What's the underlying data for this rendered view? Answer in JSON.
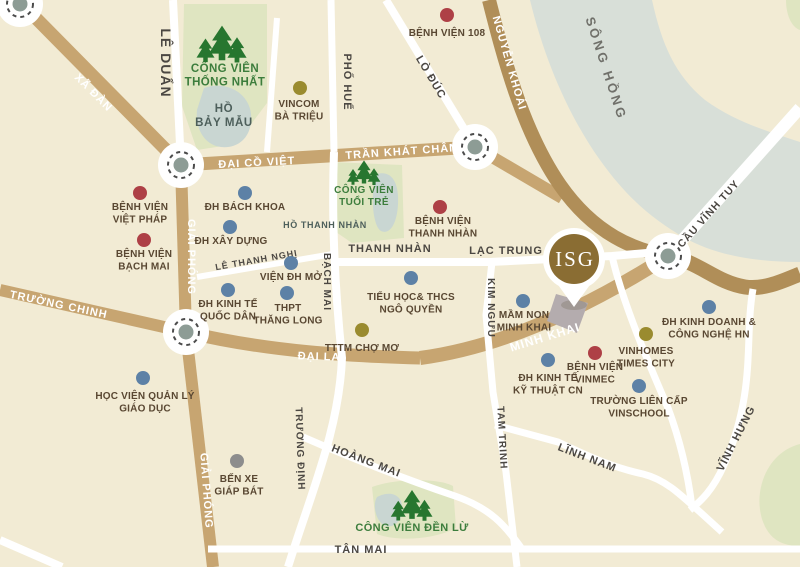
{
  "map": {
    "colors": {
      "background": "#f2ebd4",
      "road_main": "#c7a571",
      "road_dark": "#b08e58",
      "road_white": "#ffffff",
      "river": "#d8dfd8",
      "lake": "#c9d6d2",
      "park": "#dfe5c1",
      "tree_green": "#27762f",
      "park_text": "#3c7d3c",
      "lake_text": "#4d5f5b",
      "river_text": "#70706a",
      "poi_text": "#594732",
      "hospital": "#ae4046",
      "university": "#5d81a6",
      "commercial": "#9a8b2f",
      "bus": "#8d8d8d",
      "plot": "#b4acae",
      "marker_gold": "#8a6d33",
      "roundabout_dash": "#4c4c4c",
      "roundabout_center": "#8d9c95"
    },
    "river": {
      "name": "Sông Hồng",
      "path": "M530,0 L652,0 C662,45 675,75 705,100 C735,122 770,132 800,142 L800,262 C755,262 715,255 685,238 C650,218 625,195 600,160 C570,118 545,62 530,0 Z"
    },
    "parks": [
      {
        "id": "cong-vien-thong-nhat",
        "path": "M184,4 L267,4 L267,103 L236,144 L197,150 L182,106 Z"
      },
      {
        "id": "cong-vien-tuoi-tre",
        "path": "M331,162 L402,165 L404,238 L352,243 L333,230 Z"
      },
      {
        "id": "cong-vien-den-lu",
        "path": "M372,487 C400,477 441,479 453,486 L456,528 C431,541 394,541 377,534 Z"
      },
      {
        "id": "green-corner-ne",
        "path": "M786,0 L800,0 L800,30 C791,27 786,14 786,0 Z"
      },
      {
        "id": "green-corner-se",
        "path": "M800,444 C768,452 753,489 762,519 C769,541 784,546 800,546 Z"
      }
    ],
    "lakes": [
      {
        "id": "ho-bay-mau",
        "path": "M204,88 C228,80 249,94 251,114 C253,137 238,149 221,147 C204,145 195,128 197,110 Z"
      },
      {
        "id": "ho-thanh-nhan",
        "path": "M377,174 C392,170 399,183 398,204 C397,225 389,235 381,231 C372,226 370,190 377,174 Z"
      },
      {
        "id": "den-lu-lake",
        "path": "M377,497 C388,491 400,493 402,505 C404,518 396,528 386,526 C376,523 372,505 377,497 Z"
      }
    ],
    "plot": {
      "id": "isg-site-plot",
      "path": "M556,294 L588,303 L577,333 L547,321 Z"
    },
    "roads": [
      {
        "id": "xa-dan",
        "type": "main",
        "w": 13,
        "path": "M22,4 L181,165"
      },
      {
        "id": "dai-co-viet-tran-khat-chan",
        "type": "main",
        "w": 13,
        "path": "M181,165 L475,147"
      },
      {
        "id": "tkc-east-connector",
        "type": "main",
        "w": 12,
        "path": "M475,147 L562,198"
      },
      {
        "id": "giai-phong-north",
        "type": "main",
        "w": 12,
        "path": "M181,165 L186,332"
      },
      {
        "id": "giai-phong-south",
        "type": "main",
        "w": 12,
        "path": "M186,332 L213,567"
      },
      {
        "id": "truong-chinh",
        "type": "main",
        "w": 12,
        "path": "M0,290 L186,332"
      },
      {
        "id": "dai-la",
        "type": "main",
        "w": 13,
        "path": "M186,332 C270,352 350,356 420,358"
      },
      {
        "id": "minh-khai",
        "type": "main",
        "w": 14,
        "path": "M420,358 C480,350 560,325 668,256"
      },
      {
        "id": "nguyen-khoai",
        "type": "dark",
        "w": 14,
        "path": "M489,0 C503,55 522,130 560,185 C595,235 635,250 668,256"
      },
      {
        "id": "river-bank-road",
        "type": "dark",
        "w": 15,
        "path": "M668,256 C700,262 715,282 745,287 C765,290 785,280 800,274"
      },
      {
        "id": "le-duan",
        "type": "white",
        "w": 8,
        "path": "M173,0 L181,165"
      },
      {
        "id": "pho-hue",
        "type": "white",
        "w": 7,
        "path": "M331,0 L334,152"
      },
      {
        "id": "vincom-west-street",
        "type": "white",
        "w": 6,
        "path": "M277,18 L267,152"
      },
      {
        "id": "lo-duc",
        "type": "white",
        "w": 8,
        "path": "M386,0 L475,147"
      },
      {
        "id": "bach-mai-truong-dinh",
        "type": "white",
        "w": 8,
        "path": "M334,152 C331,230 336,300 342,358 C339,430 312,490 288,567"
      },
      {
        "id": "le-thanh-nghi",
        "type": "white",
        "w": 6,
        "path": "M197,277 L333,254"
      },
      {
        "id": "thanh-nhan-lac-trung",
        "type": "white",
        "w": 8,
        "path": "M333,262 L490,262 L612,256 L658,252"
      },
      {
        "id": "kim-nguu-tam-trinh",
        "type": "white",
        "w": 7,
        "path": "M492,262 L486,315 L493,392 L506,472 L517,567"
      },
      {
        "id": "lac-trung-south-street",
        "type": "white",
        "w": 7,
        "path": "M612,256 C622,300 645,355 668,408 C680,440 688,475 692,507"
      },
      {
        "id": "cau-vinh-tuy",
        "type": "white",
        "w": 12,
        "path": "M668,256 L800,108"
      },
      {
        "id": "vinh-hung",
        "type": "white",
        "w": 7,
        "path": "M753,289 C744,340 757,390 724,465 C713,490 701,501 690,510"
      },
      {
        "id": "linh-nam",
        "type": "white",
        "w": 7,
        "path": "M495,425 L558,442 C592,458 615,468 643,474 C667,480 680,494 722,532"
      },
      {
        "id": "hoang-mai",
        "type": "white",
        "w": 7,
        "path": "M303,437 C360,462 420,484 455,496 C490,508 505,525 522,549"
      },
      {
        "id": "tan-mai",
        "type": "white",
        "w": 7,
        "path": "M208,549 L800,549"
      },
      {
        "id": "sw-corner-street",
        "type": "white",
        "w": 8,
        "path": "M0,540 L62,567"
      }
    ],
    "roundabouts": [
      {
        "id": "roundabout-nw-corner",
        "x": 20,
        "y": 4
      },
      {
        "id": "roundabout-dai-co-viet",
        "x": 181,
        "y": 165
      },
      {
        "id": "roundabout-tran-khat-chan",
        "x": 475,
        "y": 147
      },
      {
        "id": "roundabout-dai-la",
        "x": 186,
        "y": 332
      },
      {
        "id": "roundabout-vinh-tuy",
        "x": 668,
        "y": 256
      }
    ],
    "street_labels": [
      {
        "t": "XÃ ĐÀN",
        "x": 91,
        "y": 95,
        "r": 45,
        "s": 11,
        "c": "w"
      },
      {
        "t": "ĐẠI CỒ VIỆT",
        "x": 257,
        "y": 166,
        "r": -3,
        "s": 11,
        "c": "w"
      },
      {
        "t": "TRẦN KHÁT CHÂN",
        "x": 402,
        "y": 155,
        "r": -4,
        "s": 11,
        "c": "w"
      },
      {
        "t": "NGUYỄN KHOÁI",
        "x": 506,
        "y": 64,
        "r": 74,
        "s": 11,
        "c": "w"
      },
      {
        "t": "GIẢI PHÓNG",
        "x": 188,
        "y": 257,
        "r": 90,
        "s": 11,
        "c": "w"
      },
      {
        "t": "GIẢI PHÓNG",
        "x": 203,
        "y": 491,
        "r": 86,
        "s": 11,
        "c": "w"
      },
      {
        "t": "TRƯỜNG CHINH",
        "x": 58,
        "y": 308,
        "r": 12,
        "s": 11,
        "c": "w"
      },
      {
        "t": "ĐẠI LA",
        "x": 319,
        "y": 360,
        "r": 2,
        "s": 11,
        "c": "w"
      },
      {
        "t": "MINH KHAI",
        "x": 546,
        "y": 341,
        "r": -17,
        "s": 12,
        "c": "w"
      },
      {
        "t": "LÊ DUẨN",
        "x": 161,
        "y": 63,
        "r": 90,
        "s": 14,
        "c": "d"
      },
      {
        "t": "PHỐ HUẾ",
        "x": 344,
        "y": 82,
        "r": 90,
        "s": 11,
        "c": "d"
      },
      {
        "t": "LÒ ĐÚC",
        "x": 428,
        "y": 79,
        "r": 59,
        "s": 11,
        "c": "d"
      },
      {
        "t": "CẦU VĨNH TUY",
        "x": 711,
        "y": 216,
        "r": -48,
        "s": 10.5,
        "c": "d"
      },
      {
        "t": "LẠC TRUNG",
        "x": 506,
        "y": 254,
        "r": 0,
        "s": 11,
        "c": "d"
      },
      {
        "t": "THANH NHÀN",
        "x": 390,
        "y": 252,
        "r": 0,
        "s": 11,
        "c": "d"
      },
      {
        "t": "LÊ THANH NGHỊ",
        "x": 257,
        "y": 263,
        "r": -10,
        "s": 9,
        "c": "d"
      },
      {
        "t": "BẠCH MAI",
        "x": 324,
        "y": 282,
        "r": 90,
        "s": 10,
        "c": "d"
      },
      {
        "t": "KIM NGƯU",
        "x": 488,
        "y": 308,
        "r": 90,
        "s": 10,
        "c": "d"
      },
      {
        "t": "TAM TRINH",
        "x": 499,
        "y": 438,
        "r": 87,
        "s": 10,
        "c": "d"
      },
      {
        "t": "TRƯƠNG ĐỊNH",
        "x": 297,
        "y": 449,
        "r": 88,
        "s": 10,
        "c": "d"
      },
      {
        "t": "HOÀNG MAI",
        "x": 365,
        "y": 464,
        "r": 21,
        "s": 11,
        "c": "d"
      },
      {
        "t": "LĨNH NAM",
        "x": 586,
        "y": 461,
        "r": 21,
        "s": 11,
        "c": "d"
      },
      {
        "t": "VĨNH HƯNG",
        "x": 739,
        "y": 440,
        "r": -63,
        "s": 11,
        "c": "d"
      },
      {
        "t": "TÂN MAI",
        "x": 361,
        "y": 553,
        "r": 0,
        "s": 11,
        "c": "d"
      }
    ],
    "area_labels": [
      {
        "id": "song-hong-label",
        "lines": [
          "SÔNG HỒNG"
        ],
        "x": 602,
        "y": 70,
        "r": 72,
        "s": 13,
        "cls": "lbl-river"
      },
      {
        "id": "ho-bay-mau-label",
        "lines": [
          "HỒ",
          "BẢY MẪU"
        ],
        "x": 224,
        "y": 112,
        "r": 0,
        "s": 11.5,
        "lh": 14,
        "cls": "lbl-lake"
      },
      {
        "id": "ho-thanh-nhan-label",
        "lines": [
          "HỒ THANH NHÀN"
        ],
        "x": 325,
        "y": 228,
        "r": 0,
        "s": 9,
        "cls": "lbl-lake"
      },
      {
        "id": "cong-vien-thong-nhat-label",
        "lines": [
          "CÔNG VIÊN",
          "THỐNG NHẤT"
        ],
        "x": 225,
        "y": 72,
        "r": 0,
        "s": 11.5,
        "lh": 13.5,
        "cls": "lbl-park"
      },
      {
        "id": "cong-vien-tuoi-tre-label",
        "lines": [
          "CÔNG VIÊN",
          "TUỔI TRẺ"
        ],
        "x": 364,
        "y": 193,
        "r": 0,
        "s": 10,
        "lh": 12,
        "cls": "lbl-park"
      },
      {
        "id": "cong-vien-den-lu-label",
        "lines": [
          "CÔNG VIÊN ĐỀN LỪ"
        ],
        "x": 412,
        "y": 531,
        "r": 0,
        "s": 11,
        "cls": "lbl-park"
      }
    ],
    "trees": [
      {
        "id": "trees-thong-nhat",
        "x": 222,
        "y": 52,
        "k": 1.5
      },
      {
        "id": "trees-tuoi-tre",
        "x": 364,
        "y": 178,
        "k": 1.0
      },
      {
        "id": "trees-den-lu",
        "x": 412,
        "y": 512,
        "k": 1.25
      }
    ],
    "pois": [
      {
        "id": "benh-vien-108",
        "cat": "hospital",
        "x": 447,
        "y": 15,
        "lx": 447,
        "ly": 36,
        "lines": [
          "BỆNH VIỆN 108"
        ]
      },
      {
        "id": "benh-vien-viet-phap",
        "cat": "hospital",
        "x": 140,
        "y": 193,
        "lx": 140,
        "ly": 210,
        "lines": [
          "BỆNH VIỆN",
          "VIỆT PHÁP"
        ]
      },
      {
        "id": "benh-vien-bach-mai",
        "cat": "hospital",
        "x": 144,
        "y": 240,
        "lx": 144,
        "ly": 257,
        "lines": [
          "BỆNH VIỆN",
          "BẠCH MAI"
        ]
      },
      {
        "id": "benh-vien-thanh-nhan",
        "cat": "hospital",
        "x": 440,
        "y": 207,
        "lx": 443,
        "ly": 224,
        "lines": [
          "BỆNH VIỆN",
          "THANH NHÀN"
        ]
      },
      {
        "id": "benh-vien-vinmec",
        "cat": "hospital",
        "x": 595,
        "y": 353,
        "lx": 595,
        "ly": 370,
        "lines": [
          "BỆNH VIỆN",
          "VINMEC"
        ]
      },
      {
        "id": "dh-bach-khoa",
        "cat": "university",
        "x": 245,
        "y": 193,
        "lx": 245,
        "ly": 210,
        "lines": [
          "ĐH BÁCH KHOA"
        ]
      },
      {
        "id": "dh-xay-dung",
        "cat": "university",
        "x": 230,
        "y": 227,
        "lx": 231,
        "ly": 244,
        "lines": [
          "ĐH XÂY DỰNG"
        ]
      },
      {
        "id": "dh-kinh-te-quoc-dan",
        "cat": "university",
        "x": 228,
        "y": 290,
        "lx": 228,
        "ly": 307,
        "lines": [
          "ĐH KINH TẾ",
          "QUỐC DÂN"
        ]
      },
      {
        "id": "vien-dh-mo",
        "cat": "university",
        "x": 291,
        "y": 263,
        "lx": 291,
        "ly": 280,
        "lines": [
          "VIỆN ĐH MỞ"
        ]
      },
      {
        "id": "thpt-thang-long",
        "cat": "university",
        "x": 287,
        "y": 293,
        "lx": 288,
        "ly": 311,
        "lines": [
          "THPT",
          "THĂNG LONG"
        ]
      },
      {
        "id": "tieu-hoc-thcs-ngo-quyen",
        "cat": "university",
        "x": 411,
        "y": 278,
        "lx": 411,
        "ly": 300,
        "lines": [
          "TIỂU HỌC& THCS",
          "NGÔ QUYỀN"
        ]
      },
      {
        "id": "mam-non-minh-khai",
        "cat": "university",
        "x": 523,
        "y": 301,
        "lx": 524,
        "ly": 318,
        "lines": [
          "MẦM NON",
          "MINH KHAI"
        ]
      },
      {
        "id": "dh-kinh-te-ky-thuat-cn",
        "cat": "university",
        "x": 548,
        "y": 360,
        "lx": 548,
        "ly": 381,
        "lines": [
          "ĐH KINH TẾ",
          "KỸ THUẬT CN"
        ]
      },
      {
        "id": "truong-lien-cap-vinschool",
        "cat": "university",
        "x": 639,
        "y": 386,
        "lx": 639,
        "ly": 404,
        "lines": [
          "TRƯỜNG LIÊN CẤP",
          "VINSCHOOL"
        ]
      },
      {
        "id": "dh-kinh-doanh-cong-nghe-hn",
        "cat": "university",
        "x": 709,
        "y": 307,
        "lx": 709,
        "ly": 325,
        "lines": [
          "ĐH KINH DOANH &",
          "CÔNG NGHỆ HN"
        ]
      },
      {
        "id": "hoc-vien-quan-ly-giao-duc",
        "cat": "university",
        "x": 143,
        "y": 378,
        "lx": 145,
        "ly": 399,
        "lines": [
          "HỌC VIỆN QUẢN LÝ",
          "GIÁO DỤC"
        ]
      },
      {
        "id": "vincom-ba-trieu",
        "cat": "commercial",
        "x": 300,
        "y": 88,
        "lx": 299,
        "ly": 107,
        "lines": [
          "VINCOM",
          "BÀ TRIỆU"
        ]
      },
      {
        "id": "tttm-cho-mo",
        "cat": "commercial",
        "x": 362,
        "y": 330,
        "lx": 362,
        "ly": 351,
        "lines": [
          "TTTM CHỢ MƠ"
        ]
      },
      {
        "id": "vinhomes-times-city",
        "cat": "commercial",
        "x": 646,
        "y": 334,
        "lx": 646,
        "ly": 354,
        "lines": [
          "VINHOMES",
          "TIMES CITY"
        ]
      },
      {
        "id": "ben-xe-giap-bat",
        "cat": "bus",
        "x": 237,
        "y": 461,
        "lx": 239,
        "ly": 482,
        "lines": [
          "BẾN XE",
          "GIÁP BÁT"
        ]
      }
    ],
    "marker": {
      "label": "ISG",
      "x": 574,
      "y": 259
    }
  }
}
